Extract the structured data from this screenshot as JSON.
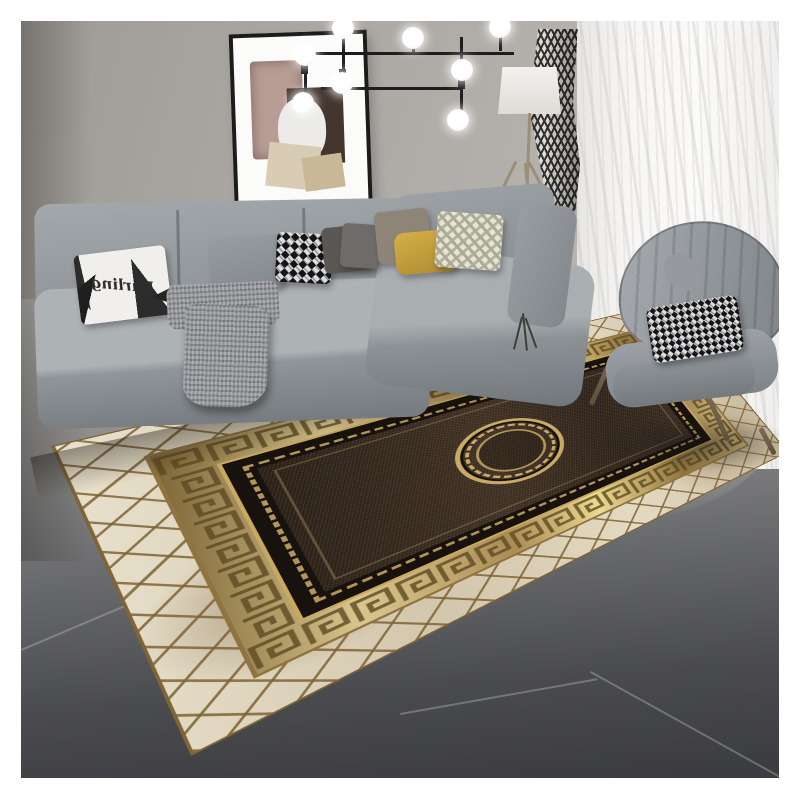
{
  "image": {
    "type": "photograph",
    "subject": "Modern living room with a luxury black-and-gold Greek key medallion area rug"
  },
  "pillow": {
    "script_text": "Darling"
  },
  "objects": {
    "rug": "Greek key medallion rug with cream diamond-lattice border",
    "sofa": "Gray L-shaped sectional sofa",
    "chair": "Gray channel-tufted wingback accent chair",
    "chandelier": "Black multi-arm chandelier with white globe bulbs",
    "floor_lamp": "Tripod floor lamp with white drum shade",
    "wall_art": "Black-framed abstract collage art",
    "curtains": "White sheer curtain and black-white chevron drape",
    "floor": "Dark gray tile floor",
    "throw": "Gray knit throw blanket",
    "plant": "Dark twig sprig"
  },
  "palette": {
    "wall": "#aaa6a1",
    "floor_dark": "#3a3b3e",
    "floor_light": "#b6b5b3",
    "sofa_gray": "#9da2a6",
    "chair_gray": "#9ea2a6",
    "rug_field_brown": "#3a2d22",
    "rug_gold": "#c9a860",
    "rug_champagne": "#d9c68e",
    "rug_cream": "#e4dac2",
    "rug_black": "#17120d",
    "pillow_yellow": "#c8a23c",
    "pillow_cream": "#e9e4d1",
    "curtain_white": "#f7f6f4",
    "fixture_black": "#1d1d1e"
  }
}
